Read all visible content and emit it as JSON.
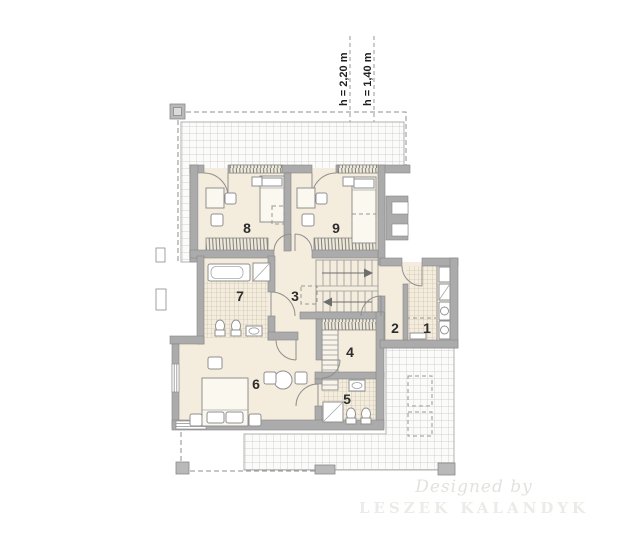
{
  "plan": {
    "height_labels": [
      {
        "text": "h = 2,20 m"
      },
      {
        "text": "h = 1,40 m"
      }
    ],
    "rooms": [
      {
        "number": "1"
      },
      {
        "number": "2"
      },
      {
        "number": "3"
      },
      {
        "number": "4"
      },
      {
        "number": "5"
      },
      {
        "number": "6"
      },
      {
        "number": "7"
      },
      {
        "number": "8"
      },
      {
        "number": "9"
      }
    ],
    "watermark": {
      "line1": "Designed by",
      "line2": "LESZEK KALANDYK"
    },
    "colors": {
      "floor": "#f4ecdd",
      "wall": "#ababab",
      "roof_hatch_line": "#c4c4c4",
      "tile_line": "#c0b5a0",
      "dash": "#8f8f8f",
      "label_text": "#2d2d2d",
      "watermark_text": "#e4e4e1"
    }
  }
}
